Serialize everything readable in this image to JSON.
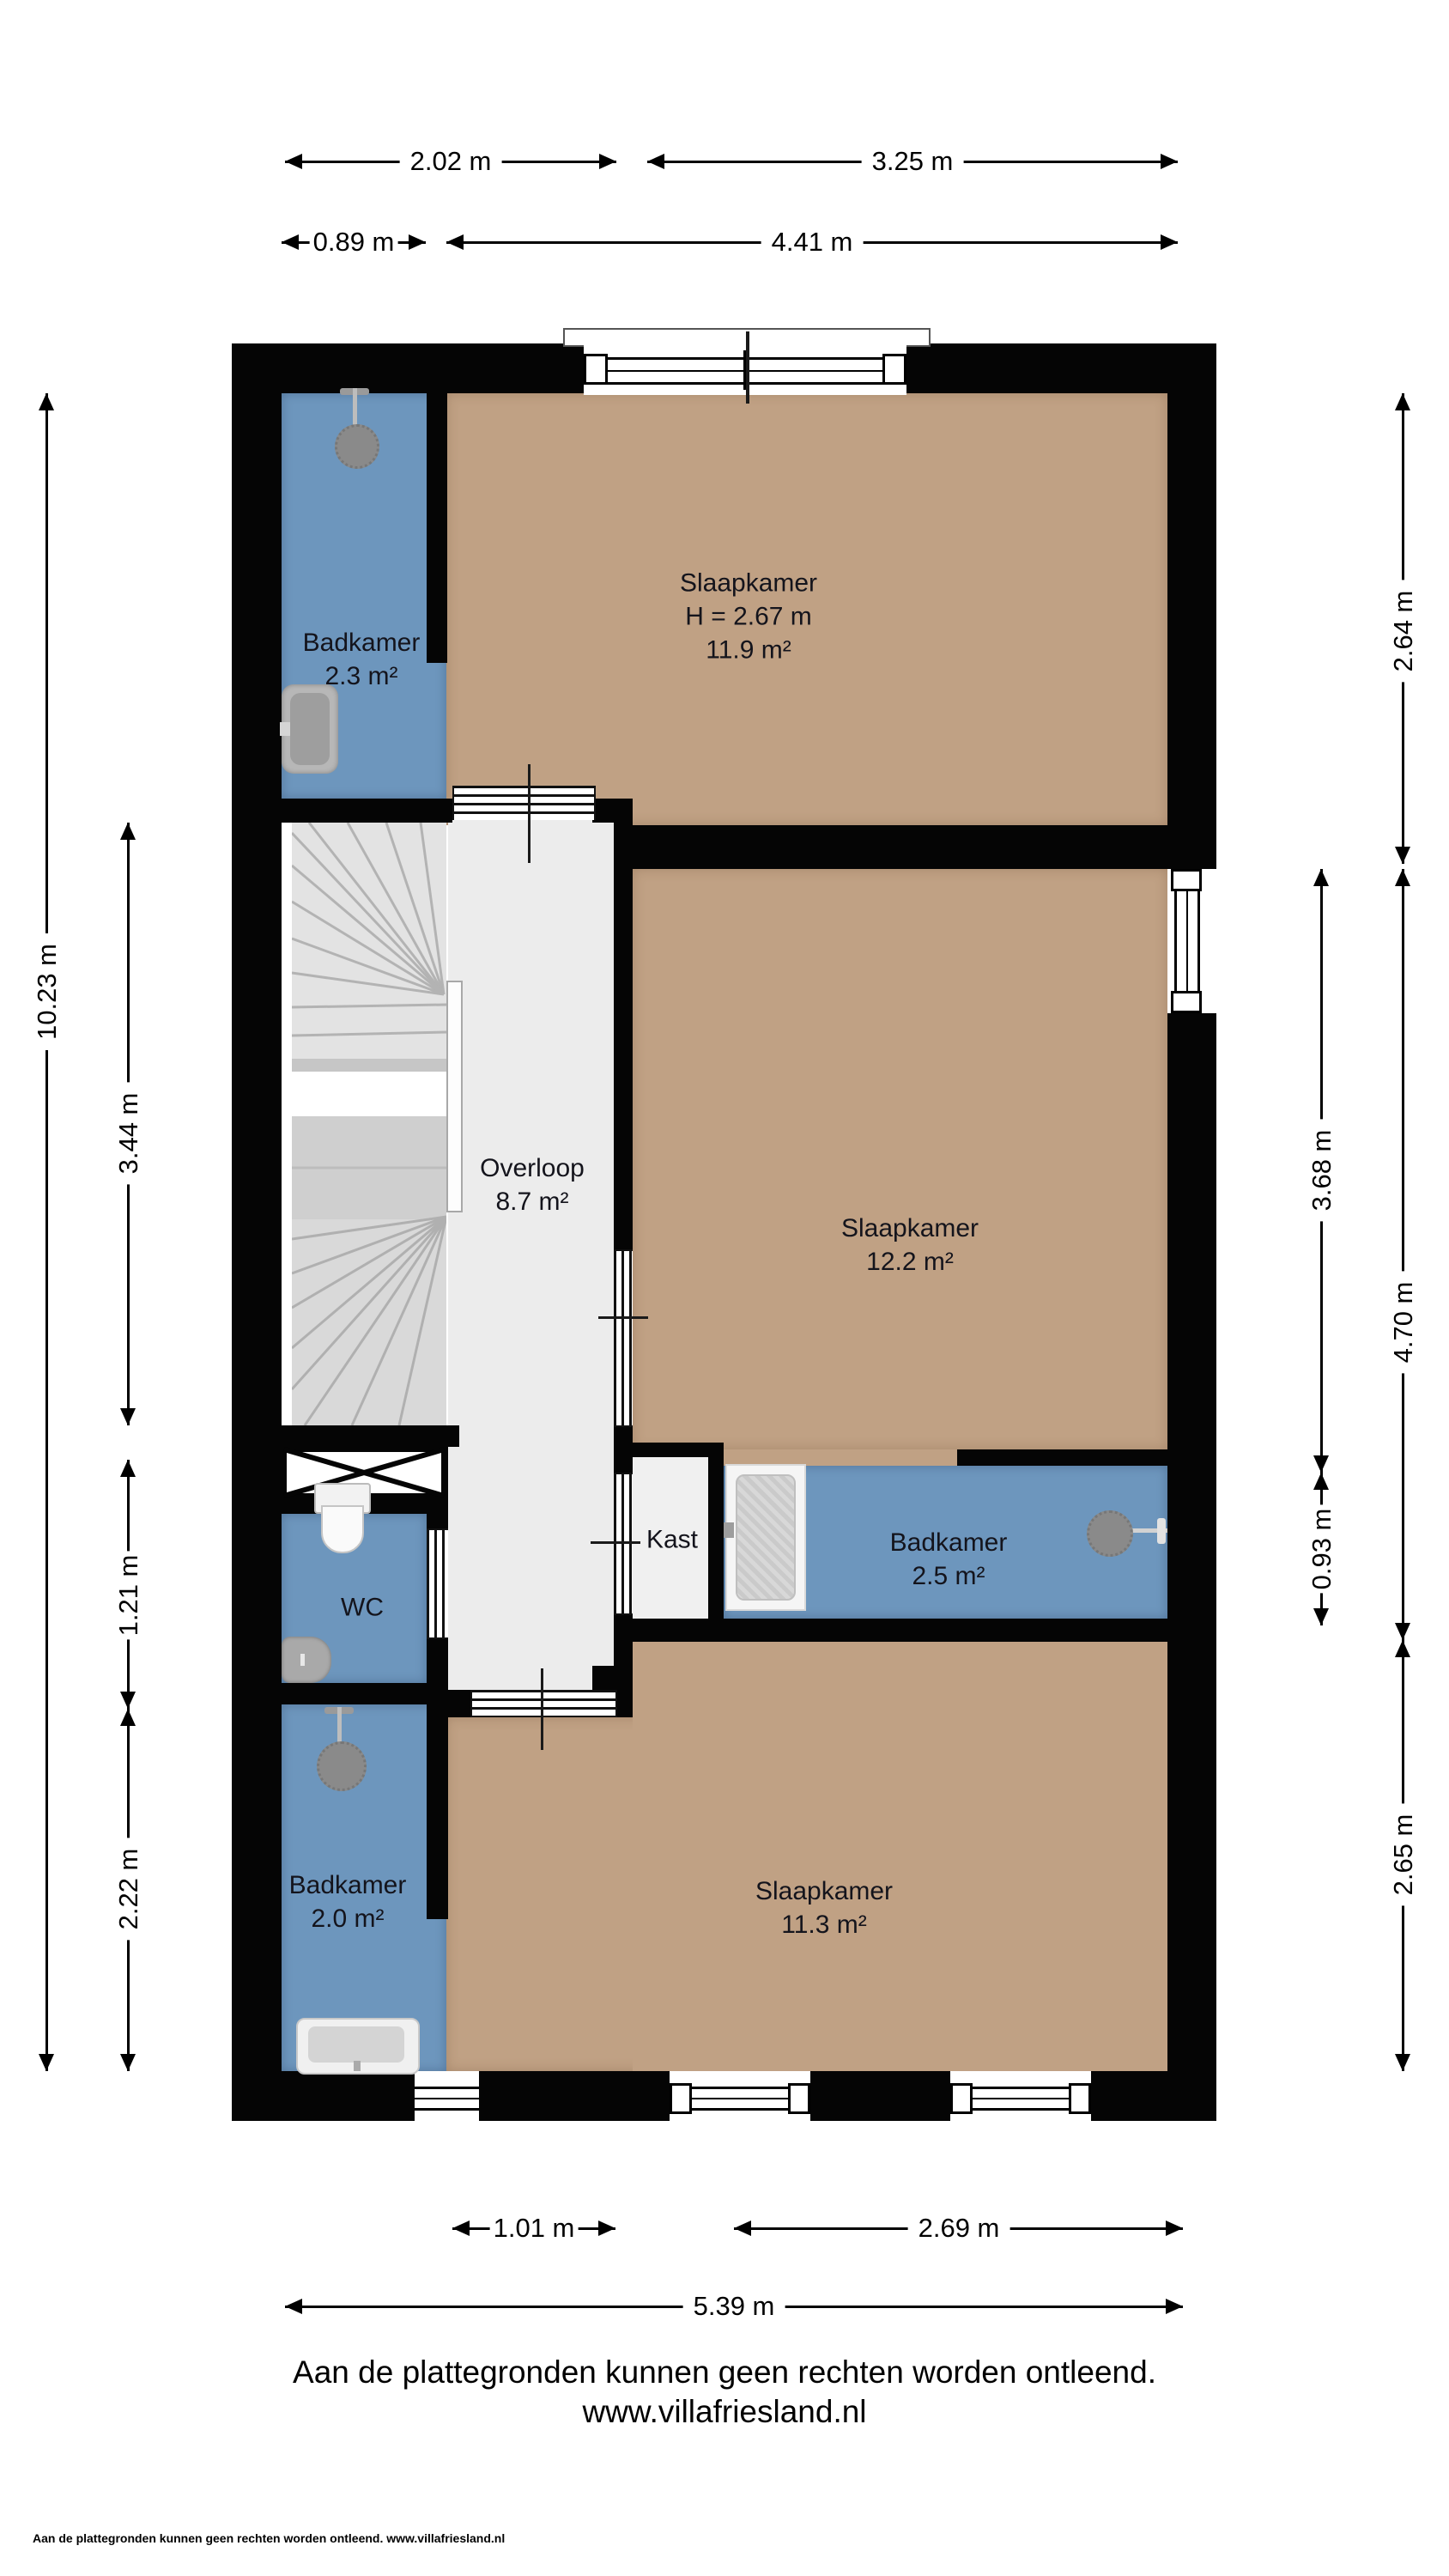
{
  "title": "Plattegrond verdieping",
  "colors": {
    "wall": "#050505",
    "room_tan": "#c0a184",
    "room_blue": "#6d96bd",
    "hall_gray": "#ececec",
    "stairs_gray": "#d9d9d9",
    "background": "#ffffff"
  },
  "rooms": {
    "slaapkamer_top": {
      "name": "Slaapkamer",
      "height": "H = 2.67 m",
      "area": "11.9 m²"
    },
    "badkamer_top": {
      "name": "Badkamer",
      "area": "2.3 m²"
    },
    "overloop": {
      "name": "Overloop",
      "area": "8.7 m²"
    },
    "slaapkamer_mid": {
      "name": "Slaapkamer",
      "area": "12.2 m²"
    },
    "kast": {
      "name": "Kast"
    },
    "badkamer_mid": {
      "name": "Badkamer",
      "area": "2.5 m²"
    },
    "wc": {
      "name": "WC"
    },
    "badkamer_bottom": {
      "name": "Badkamer",
      "area": "2.0 m²"
    },
    "slaapkamer_bottom": {
      "name": "Slaapkamer",
      "area": "11.3 m²"
    }
  },
  "dims": {
    "d202": "2.02 m",
    "d325": "3.25 m",
    "d089": "0.89 m",
    "d441": "4.41 m",
    "d101": "1.01 m",
    "d269": "2.69 m",
    "d539": "5.39 m",
    "d1023": "10.23 m",
    "d344": "3.44 m",
    "d121": "1.21 m",
    "d222": "2.22 m",
    "d368": "3.68 m",
    "d093": "0.93 m",
    "d264": "2.64 m",
    "d470": "4.70 m",
    "d265": "2.65 m"
  },
  "footer": {
    "disclaimer": "Aan de plattegronden kunnen geen rechten worden ontleend.",
    "website": "www.villafriesland.nl",
    "fineprint": "Aan de plattegronden kunnen geen rechten worden ontleend. www.villafriesland.nl"
  }
}
